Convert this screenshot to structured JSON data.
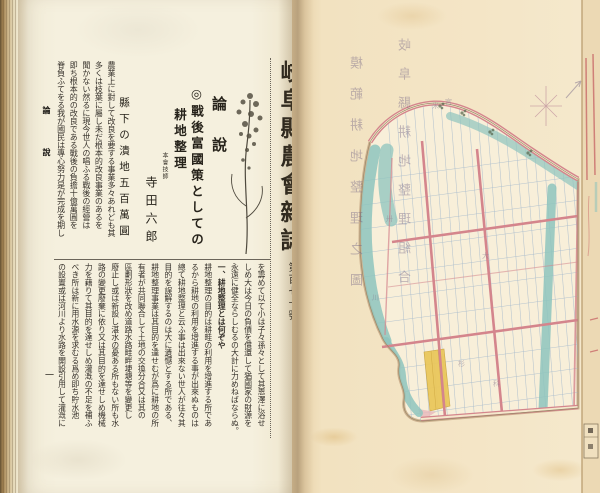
{
  "left_page": {
    "margin": {
      "section_marker": "論說",
      "page_number": "一"
    },
    "masthead": {
      "magazine_title": "岐阜縣農會雜誌",
      "issue_number": "第百七十號",
      "issue_date": "（明治四十年五月廿五日發行）"
    },
    "article": {
      "section_heading": "論說",
      "title_line1": "◎戰後富國策としての",
      "title_line2": "耕地整理",
      "author_role": "本會技師",
      "author_name": "寺田六郎",
      "side_heading": "縣下の潰地五百萬圓"
    },
    "upper_columns": [
      "農業上に對して改良を要する事業多々あれども其",
      "多くは枝葉に屬し未だ根本的改良事業のあるを",
      "聞かない然るに現今世人の唱ふる戰後の經營は",
      "即ち根本的の改良である戰後の負擔十億萬圓を",
      "脊負ふてをる我が國民は專心努力是が完成を期し"
    ],
    "lower_columns": [
      "を籌めて以て小は子々孫々として其恩澤に浴せ",
      "しめ大は今日の負債を償還して猶國家の財源を",
      "永遠に健全ならしむるの大計に力めねばならぬ。",
      "一、耕地整理とは何ぞや",
      "耕地整理の目的は耕畦の利用を增進する所であ",
      "るから耕地の利用を增進する事が出來ぬものは",
      "總て耕地整理と云ふ事は出來ない世人が往々其",
      "目的を誤解するのは大に遺憾とする所である、",
      "耕地整理事業は其目的を達せむが爲に耕地の所",
      "有者が共同聯合して土地の交換分合又は其の",
      "區劃形狀を改め道路水路畦畔埂塘等を變更し",
      "廢止し或は新設し湛水の憂ある所もない所も水",
      "路の變更廢棄に依り又は其目的を達せしめ機械",
      "力を藉りて其目的を達せしめ灌漑の不足を補ふ",
      "べき所は新に用水源を求むる爲め即ち貯水池",
      "の設置或は河川より水路を開設引用して灌漑に"
    ]
  },
  "right_page": {
    "showthrough_captions": [
      "岐阜縣耕地整理組合",
      "模範耕地整理之圖"
    ],
    "map": {
      "description": "hand-drawn cadastral map of a land-readjustment model district",
      "faint_labels": [
        "宮",
        "米",
        "大",
        "川",
        "杉",
        "科",
        "卅"
      ],
      "colors": {
        "paper": "#f3e4c4",
        "plot_fill": "#f8efd9",
        "water": "#8ec4bd",
        "road": "#d4858c",
        "grid_line": "#a9bccd",
        "village_block": "#e9c75c"
      }
    }
  }
}
